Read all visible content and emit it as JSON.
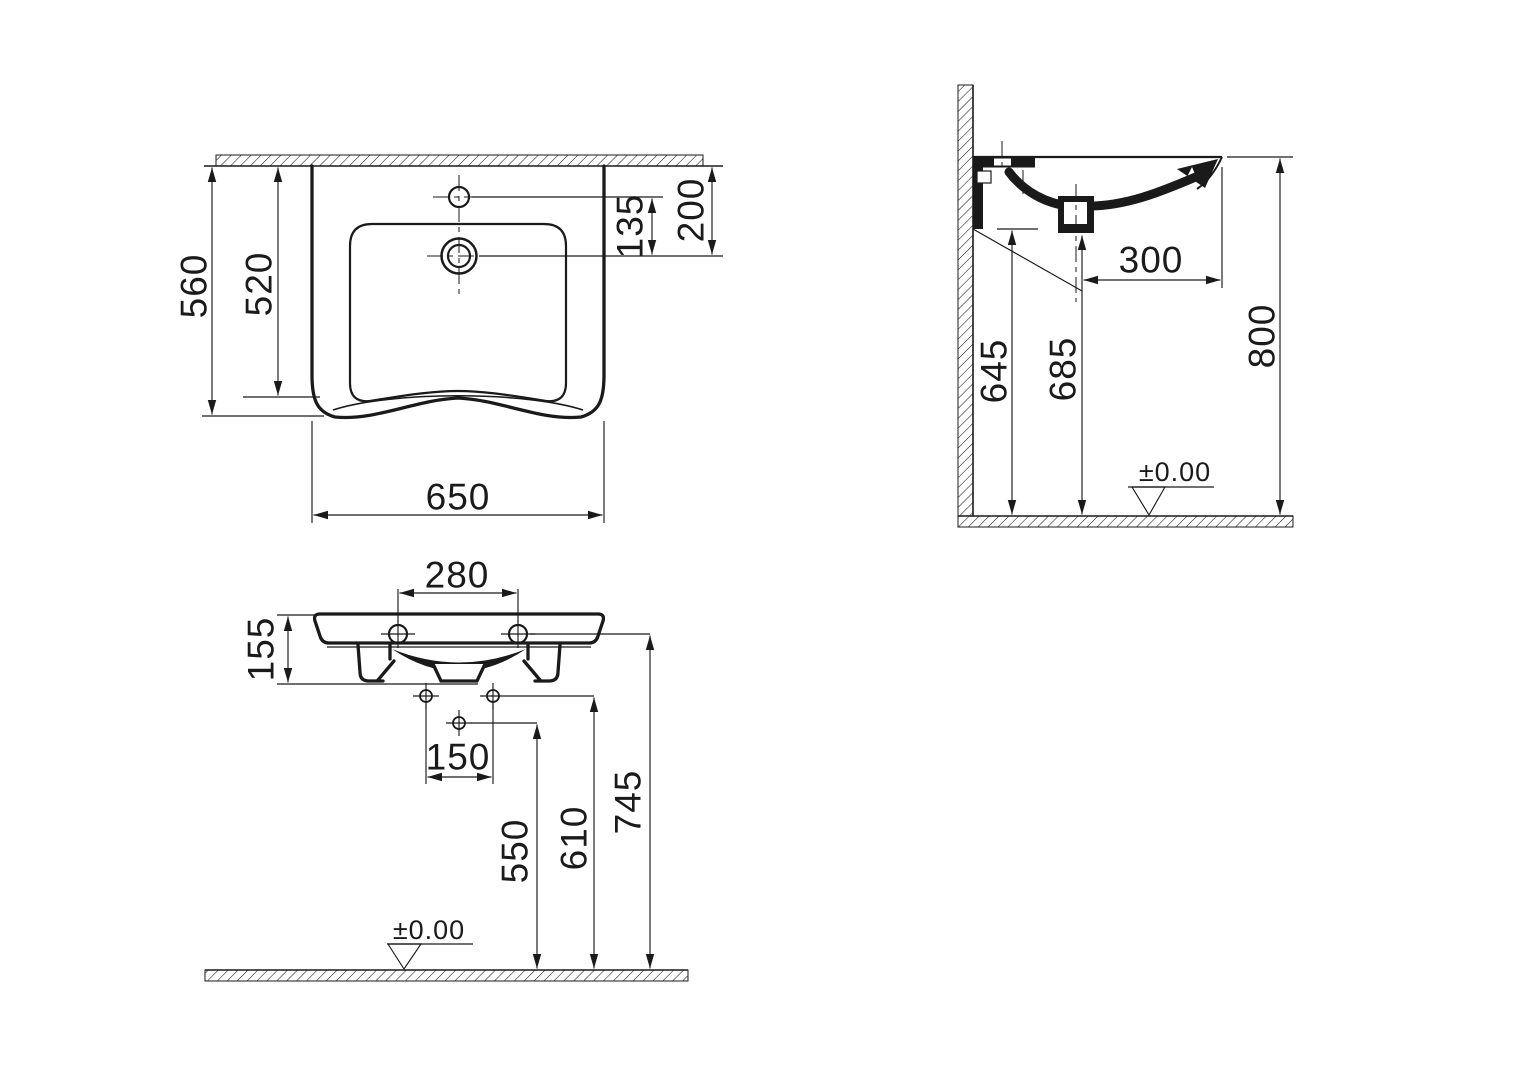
{
  "palette": {
    "background": "#ffffff",
    "ink": "#1a1a1a"
  },
  "views": {
    "front": {
      "label": "front view",
      "dims": {
        "overall_height": "560",
        "inner_depth": "520",
        "tap_to_drain": "135",
        "rim_to_drain": "200",
        "overall_width": "650"
      }
    },
    "side": {
      "label": "side section view",
      "dims": {
        "drain_offset": "300",
        "underside_height": "645",
        "drain_height": "685",
        "rim_height": "800",
        "floor_datum": "±0.00"
      }
    },
    "bottom": {
      "label": "bottom view",
      "dims": {
        "fixing_hole_spacing": "280",
        "body_depth": "155",
        "bracket_hole_spacing": "150",
        "lower_hole_height": "550",
        "bracket_hole_height": "610",
        "fixing_hole_height": "745",
        "floor_datum": "±0.00"
      }
    }
  }
}
